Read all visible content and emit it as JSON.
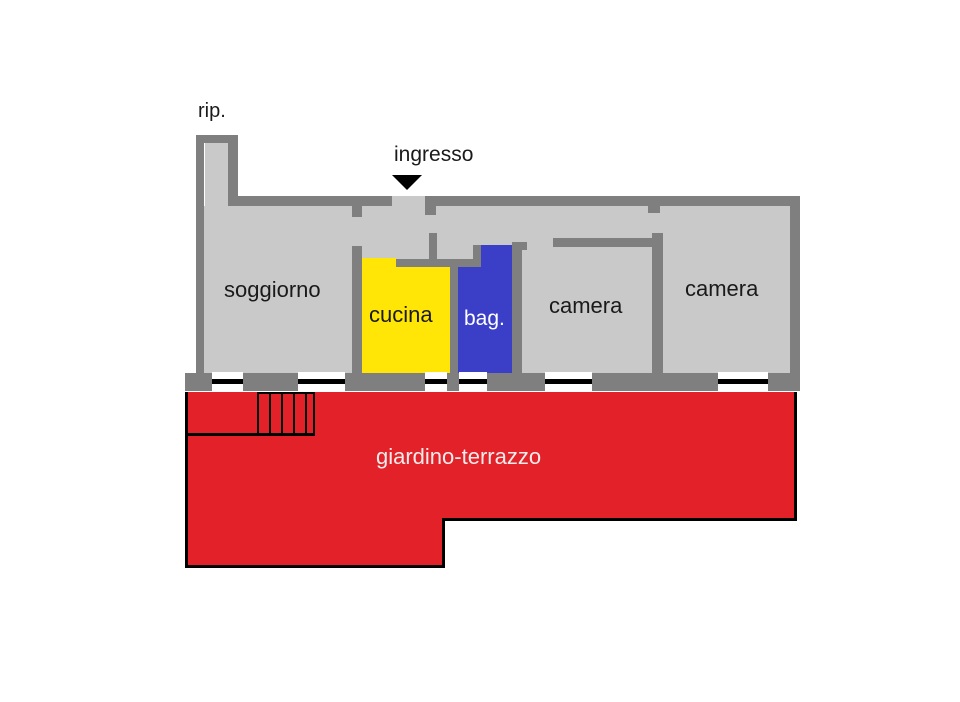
{
  "plan": {
    "labels": {
      "storage": "rip.",
      "entrance": "ingresso",
      "living": "soggiorno",
      "kitchen": "cucina",
      "bath": "bag.",
      "bedroom1": "camera",
      "bedroom2": "camera",
      "garden": "giardino-terrazzo"
    },
    "colors": {
      "wall": "#7f7f7f",
      "floor": "#c9c9c9",
      "kitchen": "#ffe606",
      "bath": "#3b3fc8",
      "garden": "#e32128",
      "window_frame": "#ffffff",
      "line": "#000000",
      "label_dark": "#1a1a1a",
      "label_light": "#f2ecec"
    }
  }
}
